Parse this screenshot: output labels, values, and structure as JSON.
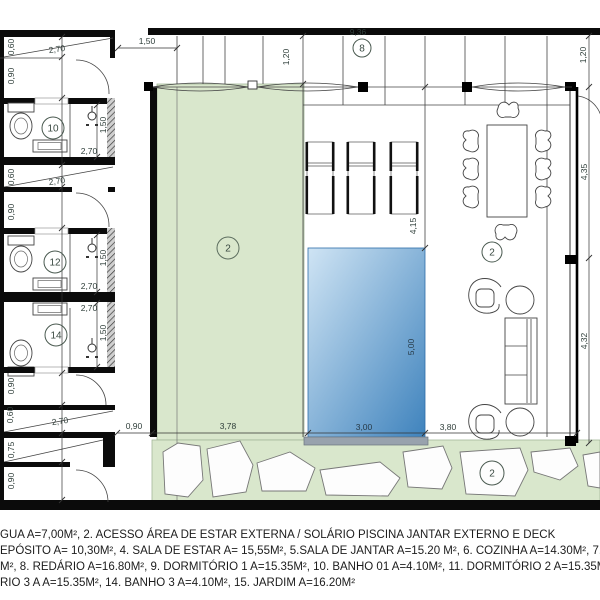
{
  "colors": {
    "deck_green": "#d9e7cc",
    "deck_border": "#a3b89a",
    "pool_light": "#cfe4f4",
    "pool_dark": "#3f83bd",
    "wall": "#0b0b0b"
  },
  "labels": {
    "bath1": "10",
    "bath2": "12",
    "bath3": "14",
    "deck": "2",
    "living": "2",
    "stones": "2",
    "pergola": "8"
  },
  "dims": {
    "ramp_top_w": "0,60",
    "ramp_top_l": "2,70",
    "pass_top": "0,90",
    "gap_top": "1,50",
    "pergola_d1": "1,20",
    "pergola_w": "9,36",
    "right_top": "1,20",
    "bath1_d": "1,50",
    "bath1_w": "2,70",
    "ramp_mid_w": "0,60",
    "ramp_mid_l": "2,70",
    "pass_mid": "0,90",
    "bath2_d": "1,50",
    "bath2_w": "2,70",
    "bath3_w": "2,70",
    "bath3_d": "1,50",
    "pass_low1": "0,90",
    "ramp_low_w": "0,60",
    "ramp_low_l": "2,70",
    "strip_low": "0,75",
    "pass_low2": "0,90",
    "bottom_a": "0,90",
    "bottom_b": "3,78",
    "pool_w": "3,00",
    "bottom_d": "3,80",
    "deck_h": "4,15",
    "pool_l": "5,00",
    "right_a": "4,35",
    "right_b": "4,32"
  },
  "legend": {
    "lines": [
      "GUA  A=7,00M², 2. ACESSO ÁREA DE ESTAR EXTERNA / SOLÁRIO PISCINA JANTAR EXTERNO E DECK",
      "EPÓSITO  A= 10,30M², 4. SALA DE ESTAR A= 15,55M², 5.SALA DE JANTAR A=15.20 M², 6. COZINHA A=14.30M², 7.",
      "M², 8. REDÁRIO A=16.80M², 9. DORMITÓRIO 1 A=15.35M², 10. BANHO 01 A=4.10M², 11. DORMITÓRIO 2 A=15.35M²,",
      "RIO 3 A A=15.35M², 14. BANHO 3 A=4.10M², 15. JARDIM  A=16.20M²"
    ]
  }
}
